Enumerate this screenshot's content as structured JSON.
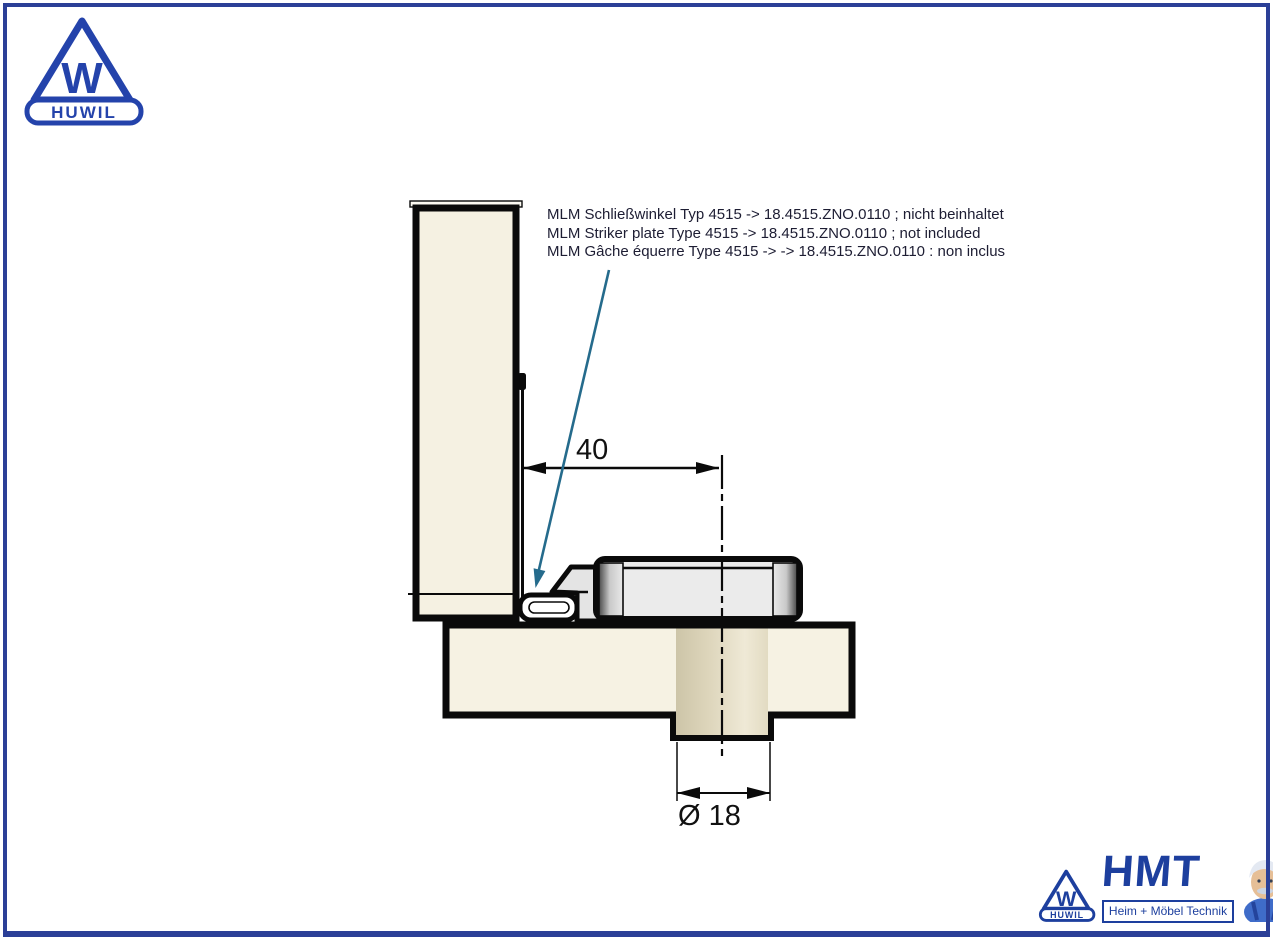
{
  "colors": {
    "frame_border": "#2b3f97",
    "logo_blue": "#2443ab",
    "hmt_blue": "#1d3f9e",
    "leader_line": "#256b8c",
    "drawing_line": "#0a0a0a",
    "wood_fill": "#f5f1e2",
    "cylinder_fill": "#d9d2b8",
    "metal_fill": "#ebebeb"
  },
  "huwil_logo": {
    "monogram": "W",
    "wordmark": "HUWIL"
  },
  "annotation": {
    "lines": [
      "MLM Schließwinkel Typ 4515 -> 18.4515.ZNO.0110 ; nicht beinhaltet",
      "MLM Striker plate Type 4515 -> 18.4515.ZNO.0110 ; not included",
      "MLM Gâche équerre Type 4515 -> -> 18.4515.ZNO.0110 : non inclus"
    ]
  },
  "dimensions": {
    "width": "40",
    "diameter": "Ø 18"
  },
  "hmt_logo": {
    "monogram": "W",
    "wordmark": "HUWIL",
    "title": "HMT",
    "subtitle": "Heim + Möbel Technik"
  }
}
